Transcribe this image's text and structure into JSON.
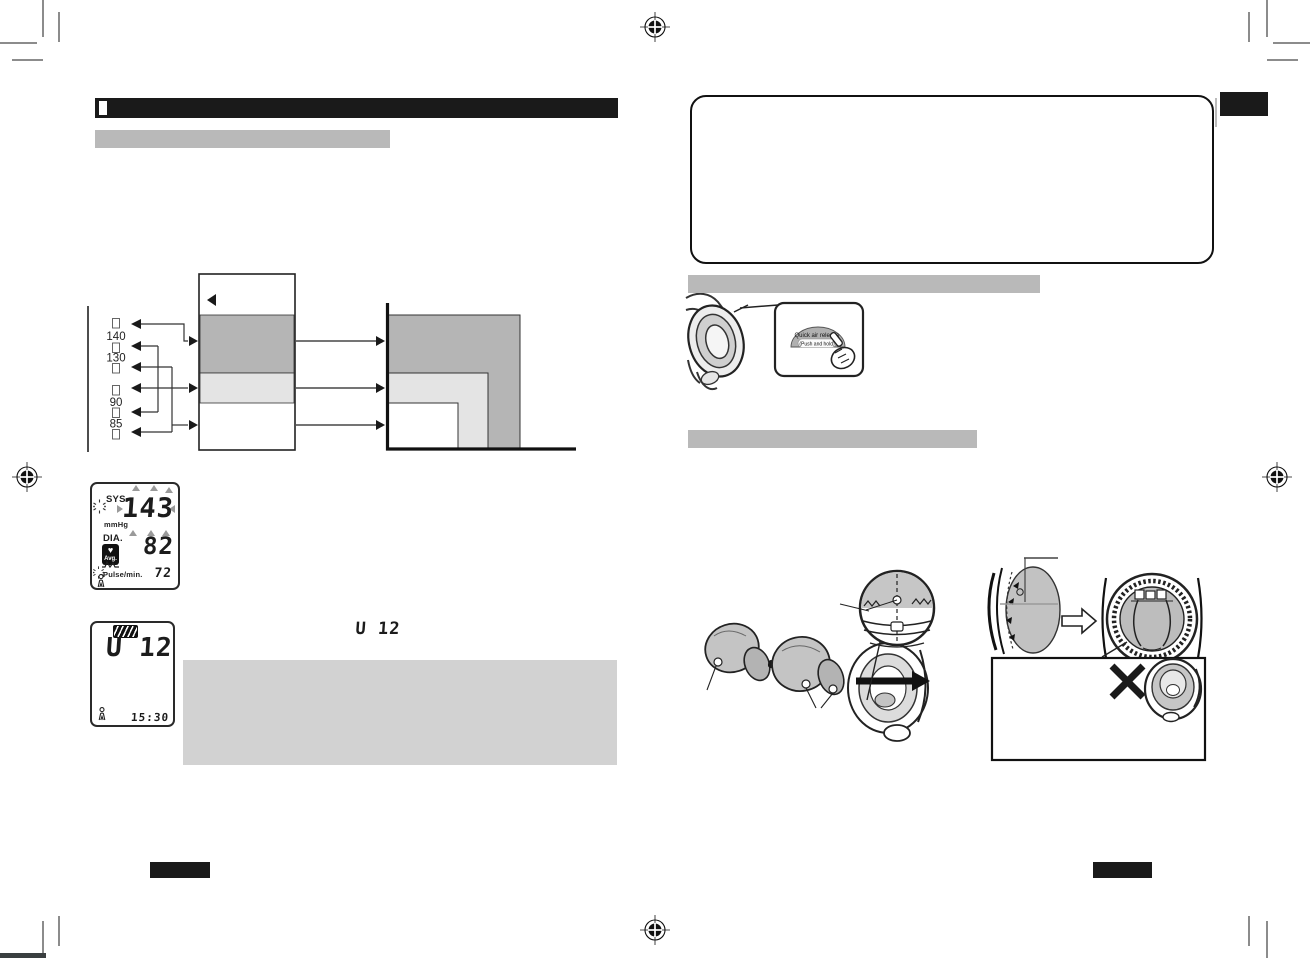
{
  "bp_chart": {
    "thresholds": [
      "140",
      "130",
      "90",
      "85"
    ],
    "unit": "mmHg"
  },
  "lcd_main": {
    "sys_label": "SYS.",
    "unit_label": "mmHg",
    "dia_label": "DIA.",
    "heart_icon": "♥",
    "avg_label": "Avg.",
    "pulse_label": "Pulse/min.",
    "sys_value": "143",
    "dia_value": "82",
    "pulse_value": "72"
  },
  "lcd_memory": {
    "value": "U 12",
    "time": "15:30"
  },
  "inline_display": {
    "value": "U 12"
  },
  "quick_release": {
    "button_label": "Quick air release",
    "button_sublabel": "(Push and hold)"
  }
}
